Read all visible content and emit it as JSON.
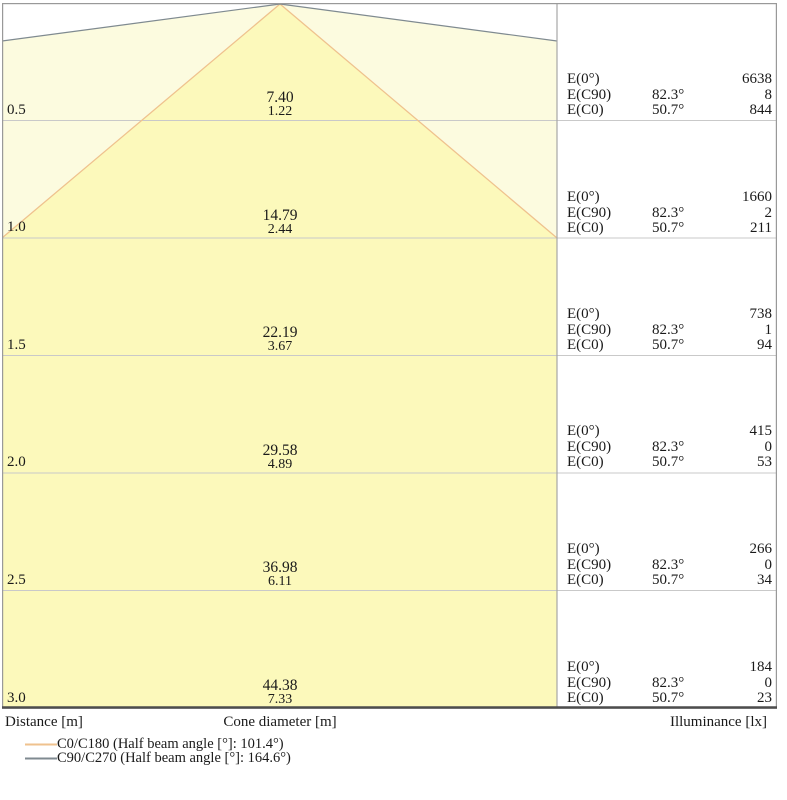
{
  "labels": {
    "e0": "E(0°)",
    "ec90": "E(C90)",
    "ec0": "E(C0)",
    "ec90_angle": "82.3°",
    "ec0_angle": "50.7°",
    "distance_axis": "Distance [m]",
    "cone_diameter_axis": "Cone diameter [m]",
    "illuminance_axis": "Illuminance [lx]"
  },
  "legend": {
    "c0": {
      "label": "C0/C180 (Half beam angle [°]: 101.4°)",
      "color": "#EFC28E"
    },
    "c90": {
      "label": "C90/C270 (Half beam angle [°]: 164.6°)",
      "color": "#7F8A90"
    }
  },
  "colors": {
    "inner_cone_fill": "#FCF9BB",
    "outer_cone_fill": "#FCFBDF",
    "c0_line": "#EFC28E",
    "c90_line": "#7F8A90",
    "gridline": "#C9C9C9",
    "border": "#999999",
    "bottom_border": "#4D4D4D"
  },
  "chart_data": {
    "type": "cone-diagram",
    "title": "",
    "xlabel": "Cone diameter [m]",
    "ylabel": "Distance [m]",
    "right_label": "Illuminance [lx]",
    "distances_m": [
      0.5,
      1.0,
      1.5,
      2.0,
      2.5,
      3.0
    ],
    "series": [
      {
        "name": "C0/C180",
        "half_beam_angle_deg": 101.4,
        "cone_diameters_m": [
          1.22,
          2.44,
          3.67,
          4.89,
          6.11,
          7.33
        ],
        "color": "#EFC28E"
      },
      {
        "name": "C90/C270",
        "half_beam_angle_deg": 164.6,
        "cone_diameters_m": [
          7.4,
          14.79,
          22.19,
          29.58,
          36.98,
          44.38
        ],
        "color": "#7F8A90"
      }
    ],
    "illuminance_lx": [
      {
        "distance_m": 0.5,
        "E0": 6638,
        "EC90": 8,
        "EC0": 844
      },
      {
        "distance_m": 1.0,
        "E0": 1660,
        "EC90": 2,
        "EC0": 211
      },
      {
        "distance_m": 1.5,
        "E0": 738,
        "EC90": 1,
        "EC0": 94
      },
      {
        "distance_m": 2.0,
        "E0": 415,
        "EC90": 0,
        "EC0": 53
      },
      {
        "distance_m": 2.5,
        "E0": 266,
        "EC90": 0,
        "EC0": 34
      },
      {
        "distance_m": 3.0,
        "E0": 184,
        "EC90": 0,
        "EC0": 23
      }
    ],
    "angles": {
      "EC90": "82.3°",
      "EC0": "50.7°"
    },
    "rows": [
      {
        "distance": "0.5",
        "d_c90": "7.40",
        "d_c0": "1.22",
        "e0": "6638",
        "ec90": "8",
        "ec0": "844"
      },
      {
        "distance": "1.0",
        "d_c90": "14.79",
        "d_c0": "2.44",
        "e0": "1660",
        "ec90": "2",
        "ec0": "211"
      },
      {
        "distance": "1.5",
        "d_c90": "22.19",
        "d_c0": "3.67",
        "e0": "738",
        "ec90": "1",
        "ec0": "94"
      },
      {
        "distance": "2.0",
        "d_c90": "29.58",
        "d_c0": "4.89",
        "e0": "415",
        "ec90": "0",
        "ec0": "53"
      },
      {
        "distance": "2.5",
        "d_c90": "36.98",
        "d_c0": "6.11",
        "e0": "266",
        "ec90": "0",
        "ec0": "34"
      },
      {
        "distance": "3.0",
        "d_c90": "44.38",
        "d_c0": "7.33",
        "e0": "184",
        "ec90": "0",
        "ec0": "23"
      }
    ]
  }
}
